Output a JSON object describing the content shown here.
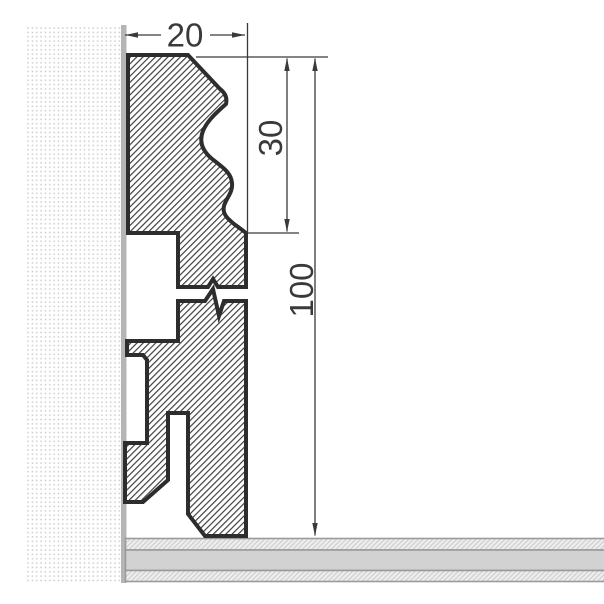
{
  "diagram": {
    "type": "technical-cross-section-drawing",
    "subject": "Skirting board profile fixed against a wall, standing on floor build-up, with a break symbol shortening the mid section",
    "dimensions": {
      "width": {
        "value": "20",
        "orientation": "horizontal",
        "measures": "profile depth from wall"
      },
      "moulding_height": {
        "value": "30",
        "orientation": "vertical",
        "measures": "decorative top moulding height"
      },
      "total_height": {
        "value": "100",
        "orientation": "vertical",
        "measures": "total skirting height above floor"
      }
    },
    "colors": {
      "outline": "#2d2d2d",
      "hatch": "#3a3a3a",
      "dimension_ink": "#3a3a3a",
      "wall_dots": "#c9c9c9",
      "wall_strip": "#b5b5b5",
      "floor_border": "#9b9b9b",
      "floor_core": "#d2d2d2",
      "floor_screed_bg": "#ededed",
      "floor_screed_line": "#c6c6c6"
    }
  }
}
